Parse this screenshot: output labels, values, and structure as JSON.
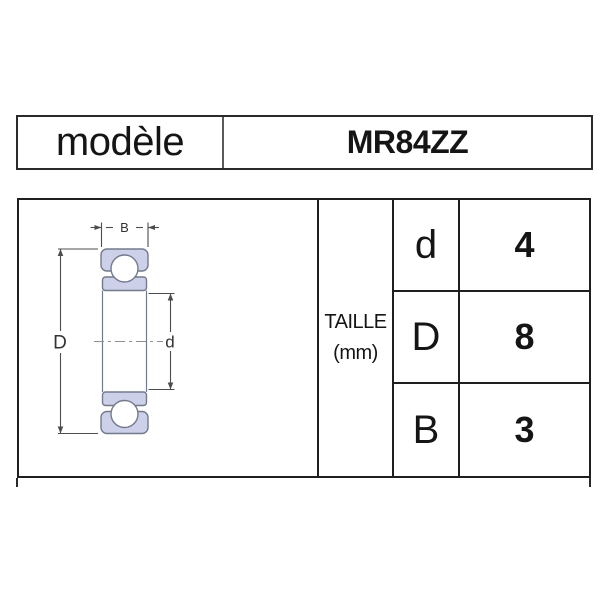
{
  "header_table": {
    "label": "modèle",
    "value": "MR84ZZ"
  },
  "spec_table": {
    "size_label_line1": "TAILLE",
    "size_label_line2": "(mm)",
    "rows": [
      {
        "param": "d",
        "value": "4"
      },
      {
        "param": "D",
        "value": "8"
      },
      {
        "param": "B",
        "value": "3"
      }
    ]
  },
  "diagram": {
    "labels": {
      "width": "B",
      "outer_diameter": "D",
      "bore_diameter": "d"
    },
    "colors": {
      "ring_fill": "#ccd0e8",
      "ring_stroke": "#737a8c",
      "dimension_line": "#4d4d4d",
      "centerline": "#8f8f8f"
    }
  }
}
